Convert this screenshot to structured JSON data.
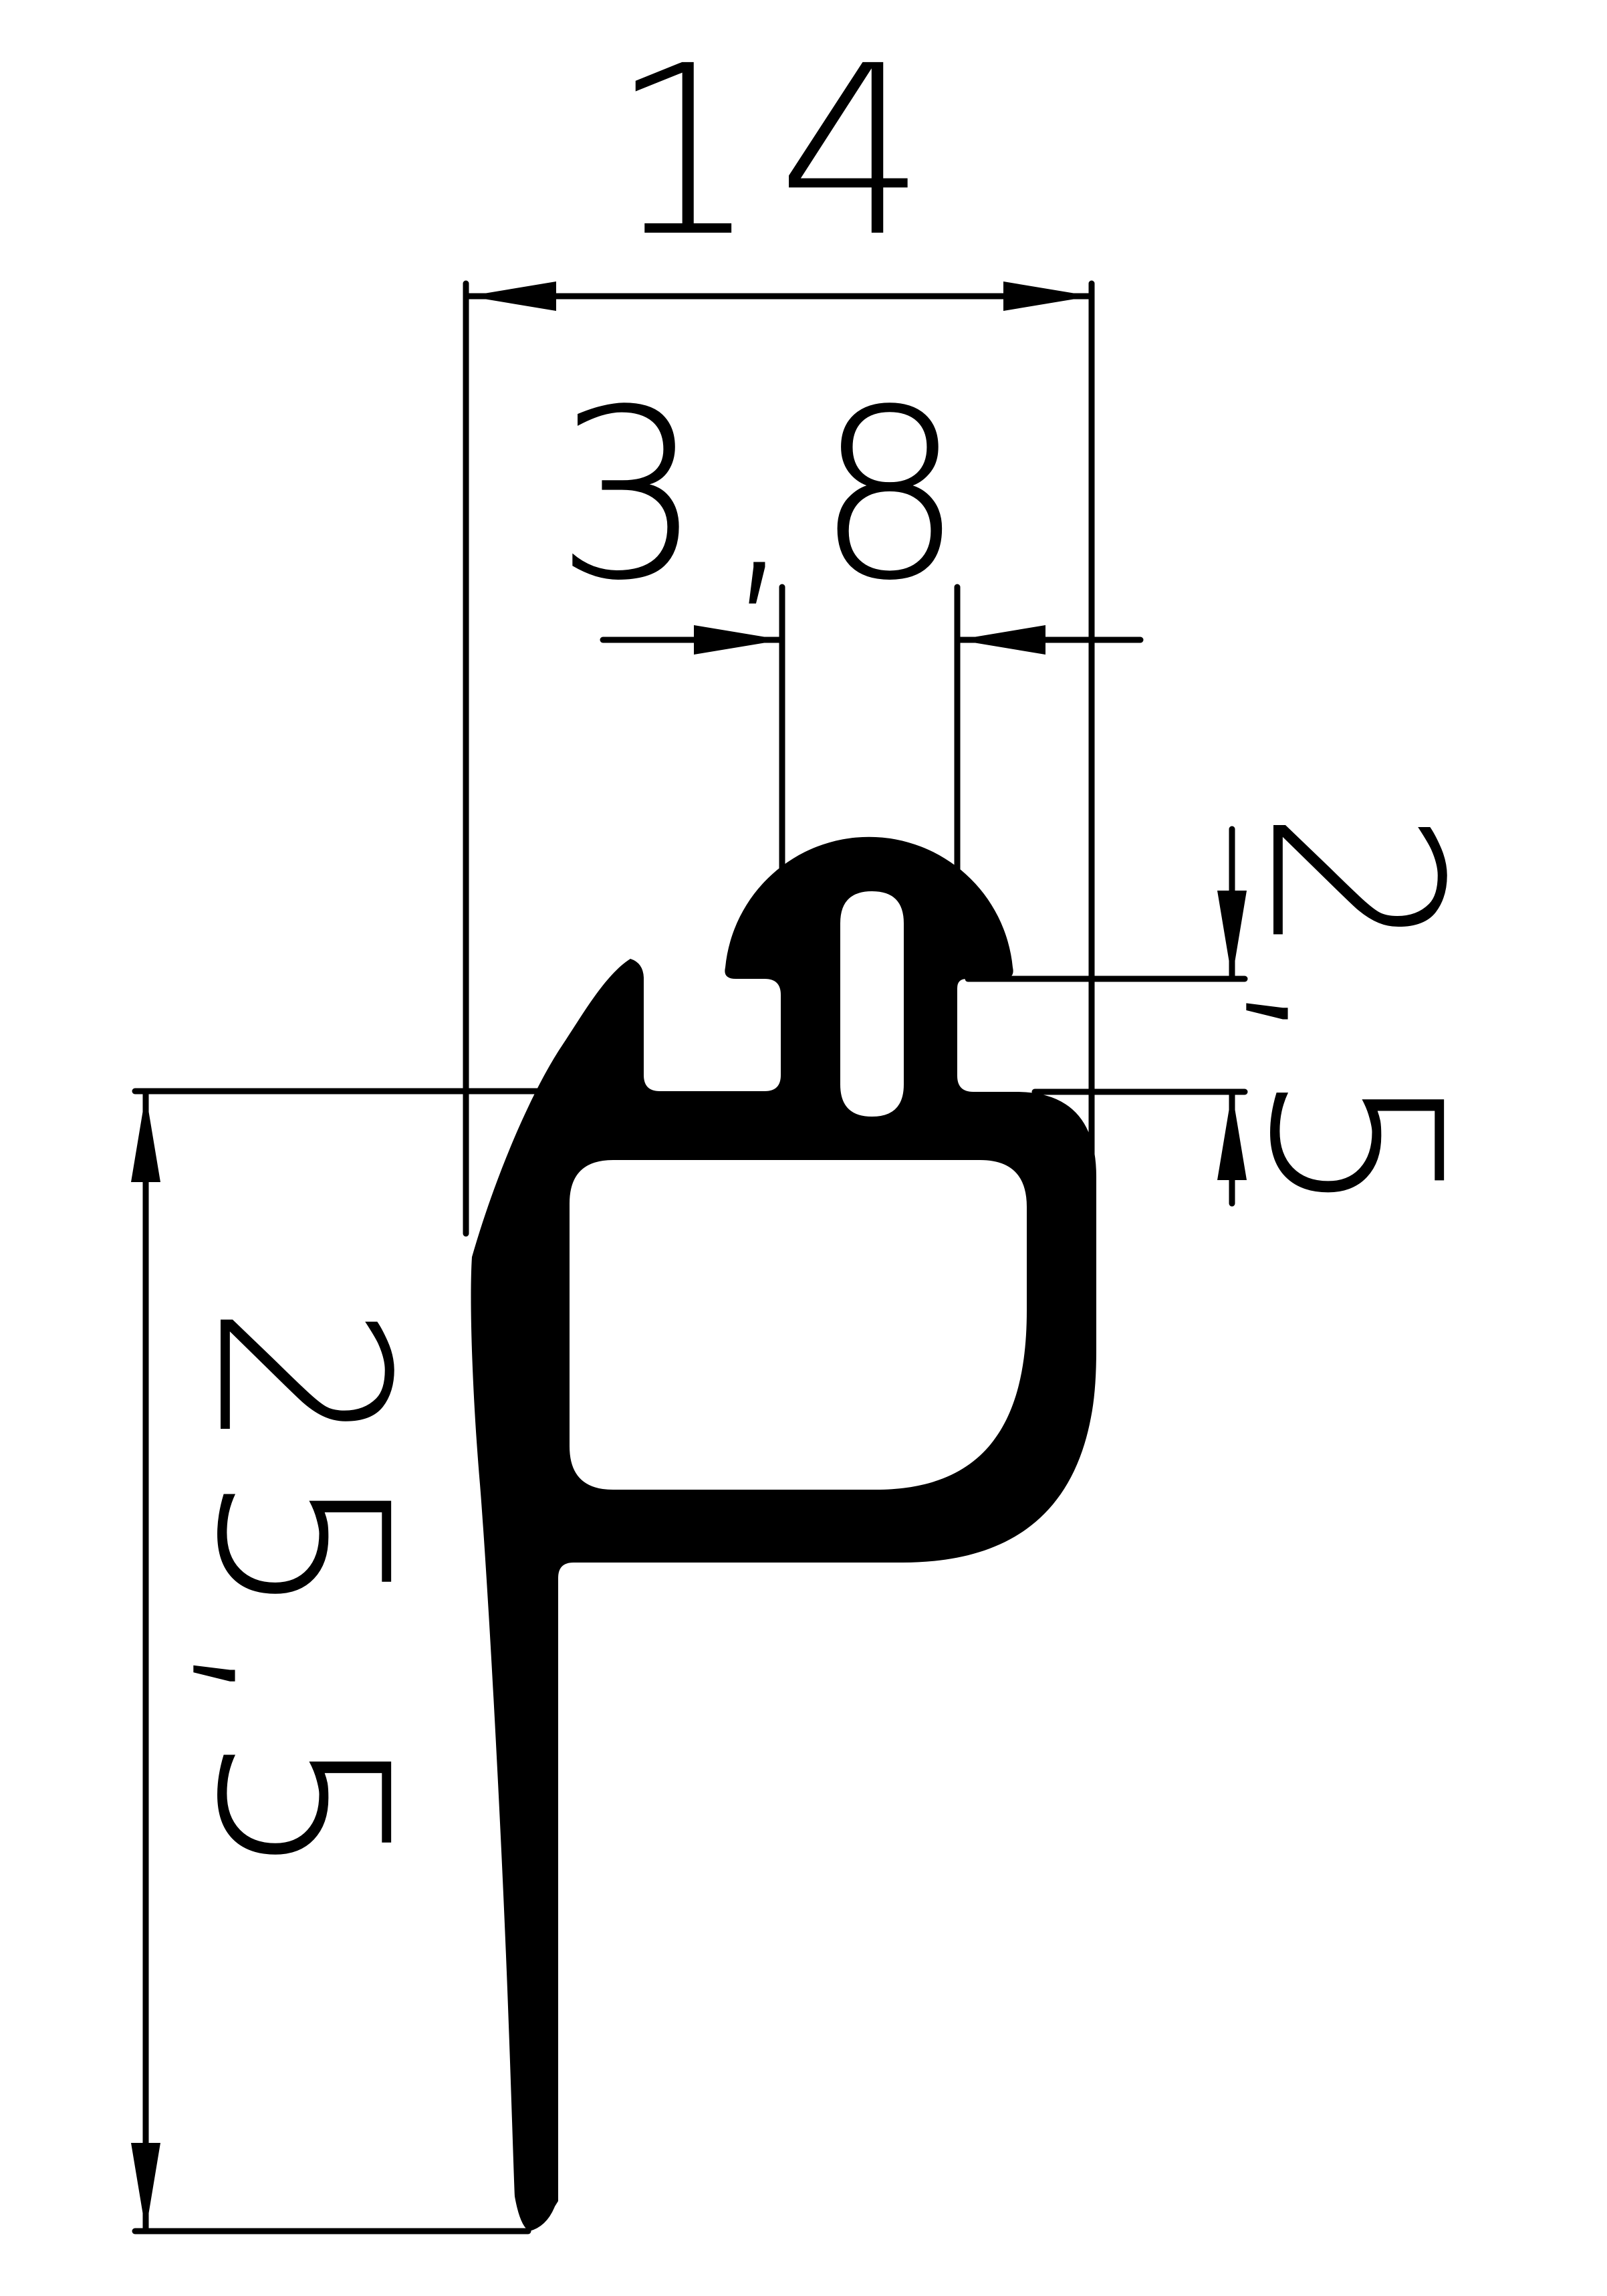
{
  "drawing": {
    "background_color": "#ffffff",
    "line_color": "#000000",
    "dimensions": {
      "overall_width": {
        "label": "14"
      },
      "stem_width": {
        "label": "3,8"
      },
      "gap_height": {
        "label": "2,5"
      },
      "overall_height": {
        "label": "25,5"
      }
    }
  }
}
